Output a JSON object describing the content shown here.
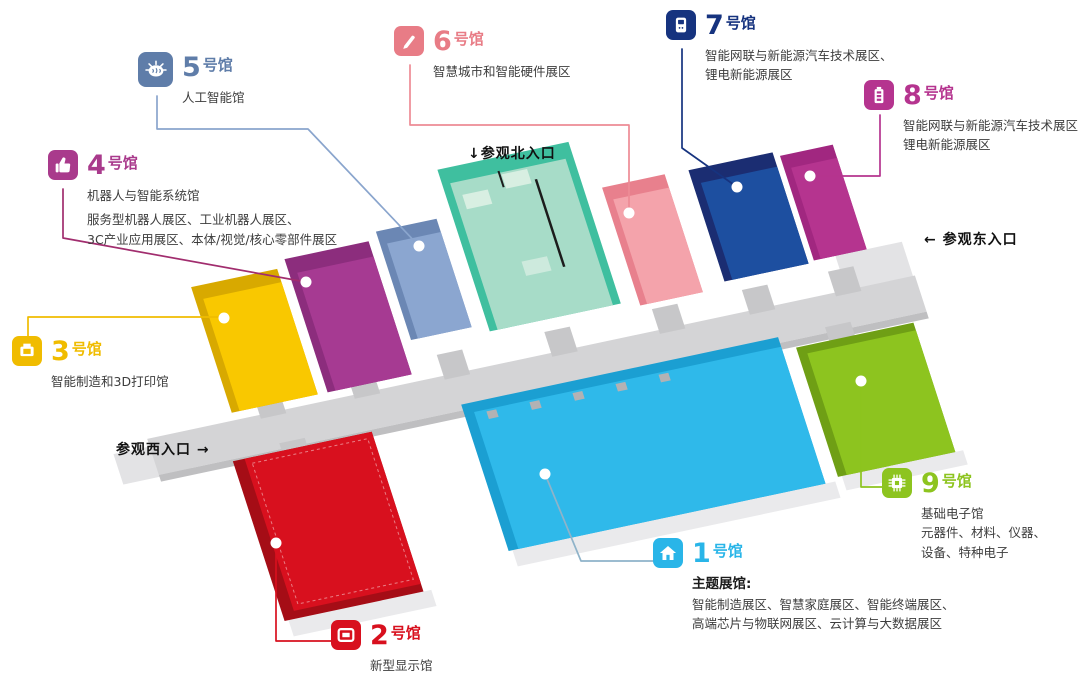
{
  "map": {
    "entrances": {
      "north": "↓参观北入口",
      "east": "← 参观东入口",
      "west": "参观西入口 →"
    },
    "halls": [
      {
        "id": "hall-1",
        "number": "1",
        "suffix": "号馆",
        "color": "#29b5e8",
        "icon": "home-icon",
        "lines": [
          "主题展馆:",
          "智能制造展区、智慧家庭展区、智能终端展区、",
          "高端芯片与物联网展区、云计算与大数据展区"
        ]
      },
      {
        "id": "hall-2",
        "number": "2",
        "suffix": "号馆",
        "color": "#d8101e",
        "icon": "display-icon",
        "lines": [
          "新型显示馆"
        ]
      },
      {
        "id": "hall-3",
        "number": "3",
        "suffix": "号馆",
        "color": "#f0bc00",
        "icon": "printer-3d-icon",
        "lines": [
          "智能制造和3D打印馆"
        ]
      },
      {
        "id": "hall-4",
        "number": "4",
        "suffix": "号馆",
        "color": "#a93a8c",
        "icon": "hand-icon",
        "lines": [
          "机器人与智能系统馆",
          "服务型机器人展区、工业机器人展区、",
          "3C产业应用展区、本体/视觉/核心零部件展区"
        ]
      },
      {
        "id": "hall-5",
        "number": "5",
        "suffix": "号馆",
        "color": "#5f7da9",
        "icon": "brain-icon",
        "lines": [
          "人工智能馆"
        ]
      },
      {
        "id": "hall-6",
        "number": "6",
        "suffix": "号馆",
        "color": "#e87c86",
        "icon": "pen-icon",
        "lines": [
          "智慧城市和智能硬件展区"
        ]
      },
      {
        "id": "hall-7",
        "number": "7",
        "suffix": "号馆",
        "color": "#16337f",
        "icon": "charging-station-icon",
        "lines": [
          "智能网联与新能源汽车技术展区、",
          "锂电新能源展区"
        ]
      },
      {
        "id": "hall-8",
        "number": "8",
        "suffix": "号馆",
        "color": "#b5348f",
        "icon": "battery-icon",
        "lines": [
          "智能网联与新能源汽车技术展区",
          "锂电新能源展区"
        ]
      },
      {
        "id": "hall-9",
        "number": "9",
        "suffix": "号馆",
        "color": "#8dc41f",
        "icon": "chip-icon",
        "lines": [
          "基础电子馆",
          "元器件、材料、仪器、",
          "设备、特种电子"
        ]
      }
    ]
  }
}
